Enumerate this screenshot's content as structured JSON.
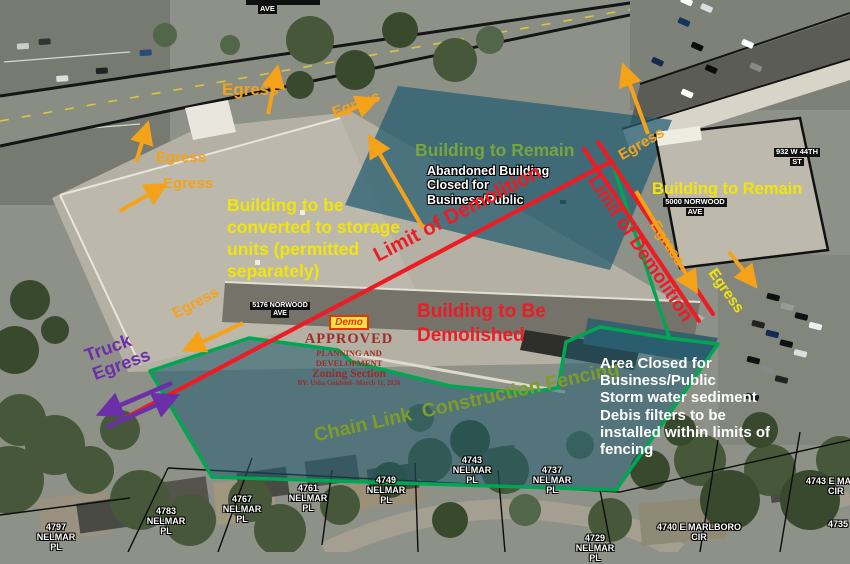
{
  "labels": {
    "egress": "Egress",
    "truck_l1": "Truck",
    "truck_l2": "Egress",
    "building_remain_center": "Building to Remain",
    "building_remain_right": "Building to Remain",
    "abandoned_l1": "Abandoned Building",
    "abandoned_l2": "Closed for",
    "abandoned_l3": "Business/Public",
    "converted_l1": "Building to be",
    "converted_l2": "converted to storage",
    "converted_l3": "units (permitted",
    "converted_l4": "separately)",
    "limit_of_demolition": "Limit of Demolition",
    "demolished_l1": "Building to Be",
    "demolished_l2": "Demolished",
    "chain_link": "Chain Link  Construction Fencing",
    "area_closed_l1": "Area Closed for",
    "area_closed_l2": "Business/Public",
    "area_closed_l3": "Storm water sediment",
    "area_closed_l4": "Debis filters to be",
    "area_closed_l5": "installed within limits of",
    "area_closed_l6": "fencing"
  },
  "stamp": {
    "demo": "Demo",
    "approved": "APPROVED",
    "dept": "PLANNING AND DEVELOPMENT",
    "section": "Zoning Section",
    "by": "BY: Usha Gokhool- March 11, 2026"
  },
  "streets": {
    "ave_top": "AVE"
  },
  "addresses": {
    "a5176_l1": "5176 NORWOOD",
    "a5176_l2": "AVE",
    "a5000_l1": "5000 NORWOOD",
    "a5000_l2": "AVE",
    "a932_l1": "932 W 44TH",
    "a932_l2": "ST"
  },
  "parcels": [
    {
      "l1": "4761 NELMAR",
      "l2": "PL"
    },
    {
      "l1": "4749 NELMAR",
      "l2": "PL"
    },
    {
      "l1": "4743 NELMAR",
      "l2": "PL"
    },
    {
      "l1": "4737 NELMAR",
      "l2": "PL"
    },
    {
      "l1": "4729 NELMAR",
      "l2": "PL"
    },
    {
      "l1": "4767 NELMAR",
      "l2": "PL"
    },
    {
      "l1": "4783 NELMAR",
      "l2": "PL"
    },
    {
      "l1": "4797 NELMAR",
      "l2": "PL"
    },
    {
      "l1": "4740 E MARLBORO",
      "l2": "CIR"
    },
    {
      "l1": "4743 E MAR",
      "l2": "CIR"
    },
    {
      "l1": "4735",
      "l2": ""
    }
  ],
  "colors": {
    "egress_orange": "#F5A21B",
    "annotation_yellow": "#F2E50B",
    "demolition_red": "#ED1C24",
    "fence_green": "#00A651",
    "remain_green": "#76A73C",
    "truck_purple": "#6B2FA8",
    "chain_olive": "#7E9C28",
    "closed_area_teal": "rgba(33,92,112,0.6)"
  }
}
